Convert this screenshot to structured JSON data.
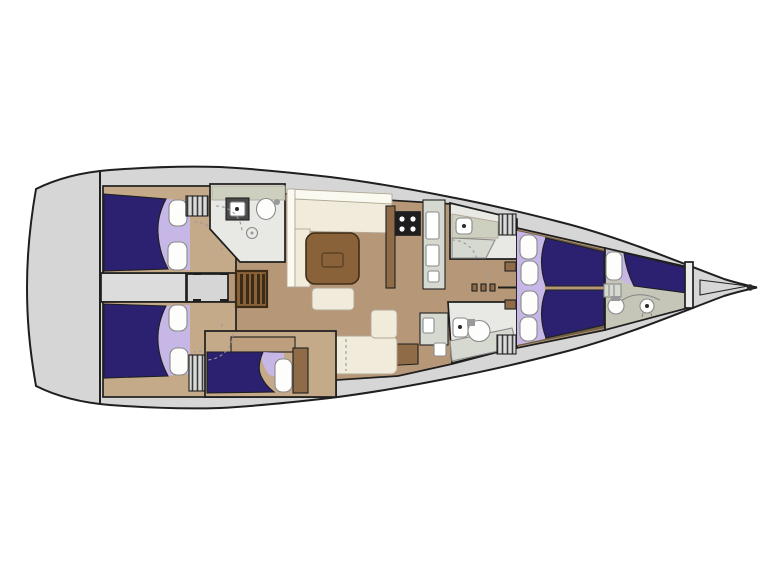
{
  "diagram": {
    "type": "yacht-interior-floor-plan",
    "orientation": "bow-right",
    "features": [
      "hull",
      "transom",
      "engine-space",
      "aft-cabin-port",
      "aft-cabin-starboard",
      "aft-head",
      "shower",
      "companionway-stairs",
      "saloon",
      "saloon-table",
      "settee",
      "ottoman",
      "chaise-longue",
      "galley",
      "stove",
      "counters",
      "mid-cabin",
      "vanity",
      "forward-head",
      "corridor",
      "master-cabin",
      "v-berth",
      "pillows",
      "crew-cabin",
      "crew-toilet",
      "crew-sink",
      "bow-bulkhead",
      "bowsprit",
      "deck-hatches",
      "door-swing-arcs",
      "centerline"
    ]
  },
  "colors": {
    "background": "#ffffff",
    "hull": "#d6d6d6",
    "outline": "#1f1f1f",
    "berth_navy": "#2b2170",
    "lavender": "#c6b7e6",
    "pillow_white": "#fdfdfc",
    "floor_tan": "#b69879",
    "floor_tan_light": "#c5aa8a",
    "shelf_tan": "#bd9e7d",
    "cream": "#f0ebda",
    "backrest_white": "#fbfaf1",
    "table_brown": "#8a6239",
    "wood_mid": "#8f6c47",
    "wood_dark": "#3c2b16",
    "counter_gray": "#d6d9d0",
    "counter_beige": "#cdd0bf",
    "bath_floor": "#e8e8e5",
    "gray_room": "#dcdcdc",
    "gray_room2": "#d6d6d6",
    "crew_floor": "#c6c6b8",
    "appliance_dark": "#1e1e1e",
    "appliance_mid": "#4a4a4a",
    "hatch_bg": "#d9d9d9",
    "hatch_line": "#3a3a3a",
    "trim_brown": "#6f5f45",
    "steel_gray": "#999999",
    "white": "#ffffff",
    "dot_dark": "#2a2a2a",
    "bulkhead_fill": "#ececea"
  }
}
